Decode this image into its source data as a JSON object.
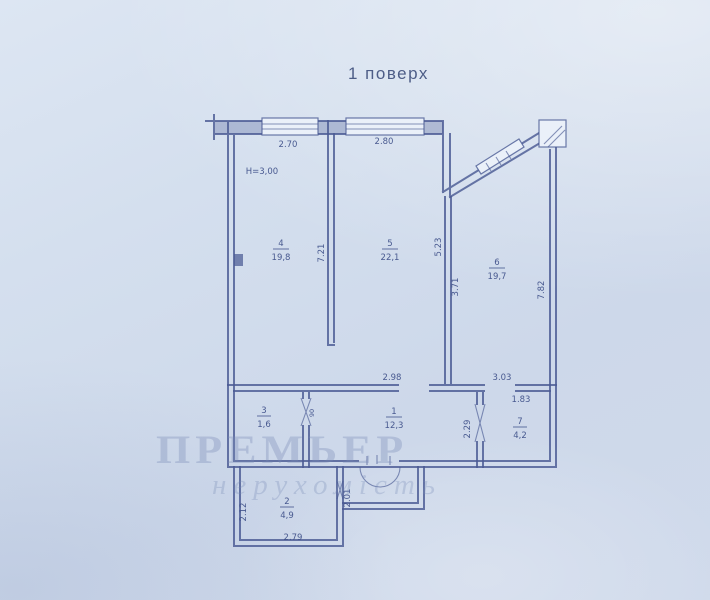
{
  "title": "1 поверх",
  "watermark": {
    "line1": "Премьер",
    "line2": "нерухомість"
  },
  "plan": {
    "height_note": "Н=3,00",
    "rooms": [
      {
        "num": "4",
        "area": "19,8"
      },
      {
        "num": "5",
        "area": "22,1"
      },
      {
        "num": "6",
        "area": "19,7"
      },
      {
        "num": "3",
        "area": "1,6"
      },
      {
        "num": "1",
        "area": "12,3"
      },
      {
        "num": "7",
        "area": "4,2"
      },
      {
        "num": "2",
        "area": "4,9"
      }
    ],
    "dims": {
      "window_left": "2.70",
      "window_right": "2.80",
      "room5_width": "2.98",
      "room6_width": "3.03",
      "room7_width": "1.83",
      "balcony_width": "2.79",
      "room4_depth": "7.21",
      "room6_left": "5.23",
      "room6_diagonal": "3.71",
      "right_wall": "7.82",
      "room7_depth": "2.29",
      "balcony_left": "2.12",
      "porch_depth": "2.01",
      "door_width": "90"
    }
  }
}
